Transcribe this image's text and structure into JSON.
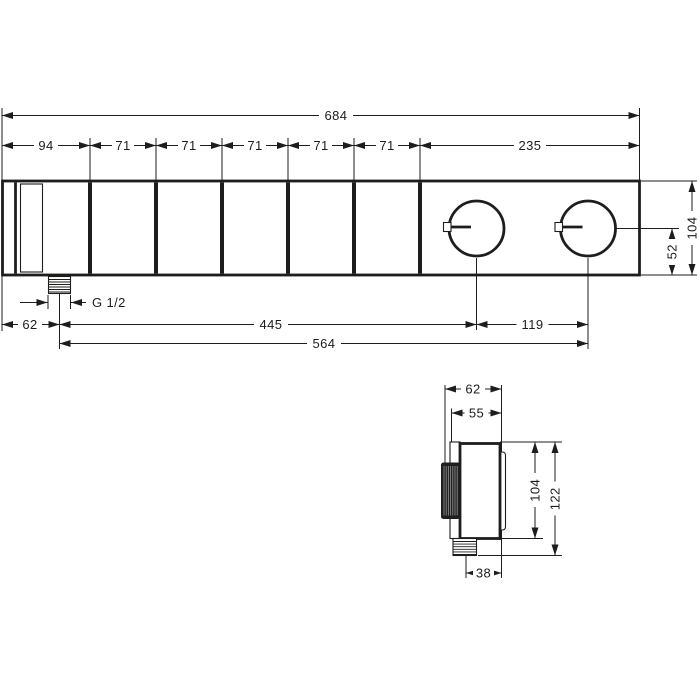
{
  "drawing": {
    "title": "thermostat-module-dimensional-drawing",
    "colors": {
      "line": "#1d1d1b",
      "background": "#ffffff"
    },
    "top_view": {
      "dim_overall": "684",
      "dim_segments": [
        "94",
        "71",
        "71",
        "71",
        "71",
        "71",
        "235"
      ],
      "dim_height": "104",
      "dim_knob_center_to_bottom": "52",
      "dim_edge_to_inlet": "62",
      "thread_label": "G 1/2",
      "dim_inlet_to_knob1": "445",
      "dim_knob_spacing": "119",
      "dim_inlet_to_knob2": "564"
    },
    "side_view": {
      "dim_depth_total": "62",
      "dim_depth_body": "55",
      "dim_height_body": "104",
      "dim_height_total": "122",
      "dim_inlet_to_back": "38"
    }
  }
}
